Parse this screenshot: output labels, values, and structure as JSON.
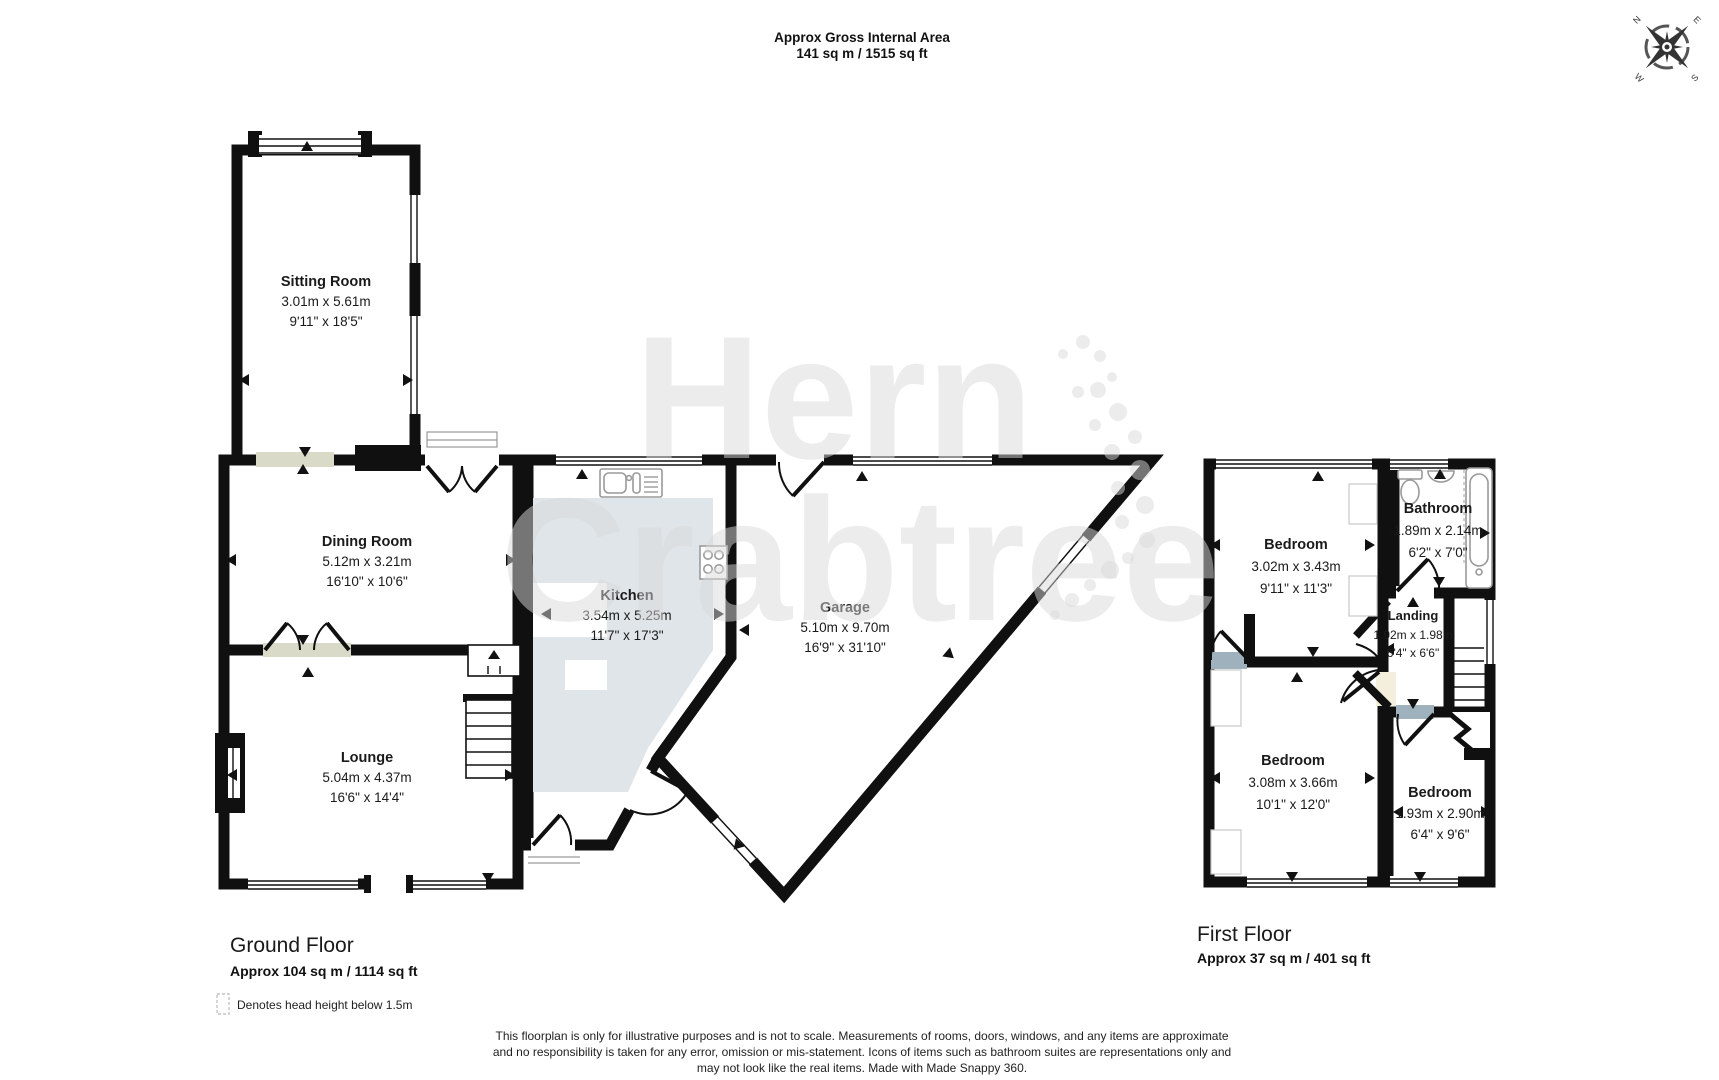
{
  "header": {
    "title": "Approx Gross Internal Area",
    "area": "141 sq m / 1515 sq ft"
  },
  "compass": {
    "n": "N",
    "e": "E",
    "s": "S",
    "w": "W"
  },
  "watermark": {
    "line1": "Hern",
    "line2": "Crabtree"
  },
  "ground_floor": {
    "title": "Ground Floor",
    "area": "Approx 104 sq m / 1114 sq ft",
    "rooms": {
      "sitting": {
        "name": "Sitting Room",
        "metric": "3.01m x 5.61m",
        "imperial": "9'11\" x 18'5\""
      },
      "dining": {
        "name": "Dining Room",
        "metric": "5.12m x 3.21m",
        "imperial": "16'10\" x 10'6\""
      },
      "lounge": {
        "name": "Lounge",
        "metric": "5.04m x 4.37m",
        "imperial": "16'6\" x 14'4\""
      },
      "kitchen": {
        "name": "Kitchen",
        "metric": "3.54m x 5.25m",
        "imperial": "11'7\" x 17'3\""
      },
      "garage": {
        "name": "Garage",
        "metric": "5.10m x 9.70m",
        "imperial": "16'9\" x 31'10\""
      }
    }
  },
  "first_floor": {
    "title": "First Floor",
    "area": "Approx 37 sq m / 401 sq ft",
    "rooms": {
      "bedroom1": {
        "name": "Bedroom",
        "metric": "3.02m x 3.43m",
        "imperial": "9'11\" x 11'3\""
      },
      "bathroom": {
        "name": "Bathroom",
        "metric": "1.89m x 2.14m",
        "imperial": "6'2\" x 7'0\""
      },
      "landing": {
        "name": "Landing",
        "metric": "1.92m x 1.98m",
        "imperial": "6'4\" x 6'6\""
      },
      "bedroom2": {
        "name": "Bedroom",
        "metric": "3.08m x 3.66m",
        "imperial": "10'1\" x 12'0\""
      },
      "bedroom3": {
        "name": "Bedroom",
        "metric": "1.93m x 2.90m",
        "imperial": "6'4\" x 9'6\""
      }
    }
  },
  "legend": {
    "text": "Denotes head height below 1.5m"
  },
  "disclaimer": {
    "line1": "This floorplan is only for illustrative purposes and is not to scale. Measurements of rooms, doors, windows, and any items are approximate",
    "line2": "and no responsibility is taken for any error, omission or mis-statement. Icons of items such as bathroom suites are representations only and",
    "line3": "may not look like the real items. Made with Made Snappy 360."
  },
  "colors": {
    "wall": "#101010",
    "sage_room": "#d9dbc8",
    "kitchen_floor": "#dfe5e9",
    "garage": "#c5aab0",
    "bedroom": "#9fb1bd",
    "landing": "#f4eedd",
    "watermark": "#d9d9d9"
  }
}
